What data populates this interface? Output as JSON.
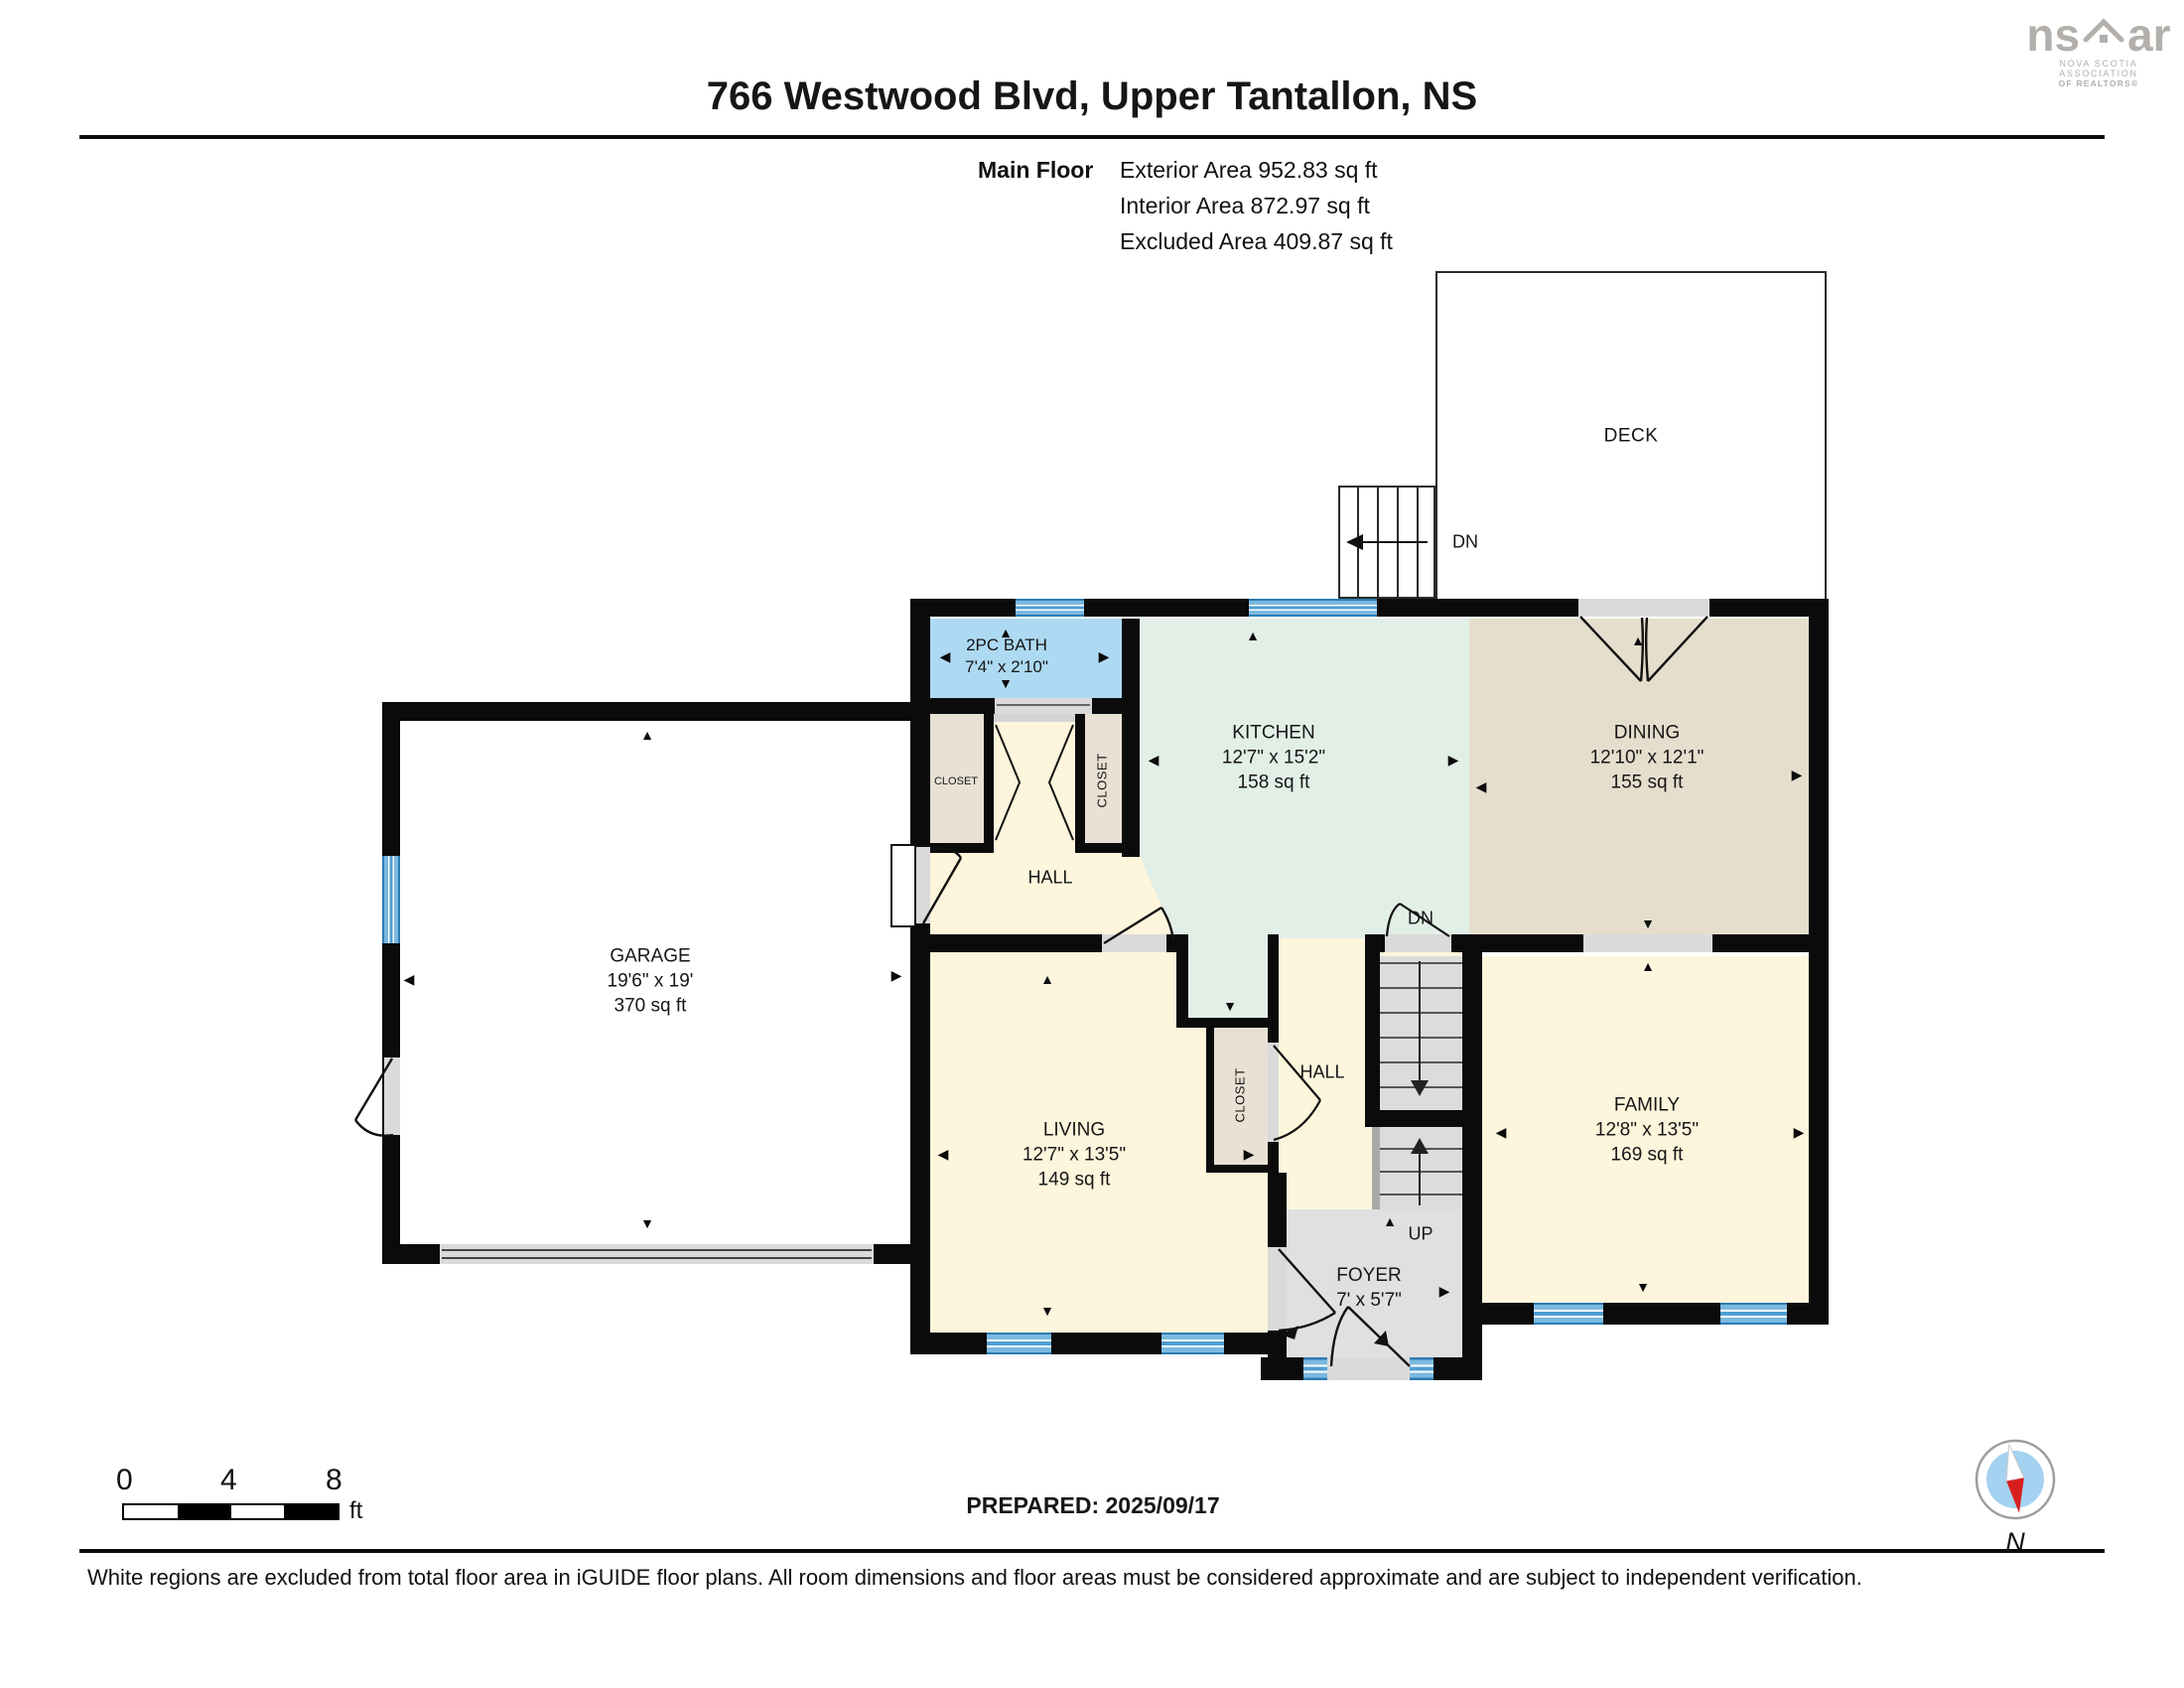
{
  "header": {
    "title": "766 Westwood Blvd, Upper Tantallon, NS",
    "floor_label": "Main Floor",
    "areas": [
      "Exterior Area 952.83 sq ft",
      "Interior Area 872.97 sq ft",
      "Excluded Area 409.87 sq ft"
    ]
  },
  "logo": {
    "brand_left": "ns",
    "brand_right": "ar",
    "line1": "NOVA SCOTIA ASSOCIATION",
    "line2": "OF REALTORS®"
  },
  "rooms": {
    "deck": {
      "name": "DECK"
    },
    "garage": {
      "name": "GARAGE",
      "dim": "19'6\" x 19'",
      "area": "370 sq ft"
    },
    "bath": {
      "name": "2PC BATH",
      "dim": "7'4\" x 2'10\""
    },
    "kitchen": {
      "name": "KITCHEN",
      "dim": "12'7\" x 15'2\"",
      "area": "158 sq ft"
    },
    "dining": {
      "name": "DINING",
      "dim": "12'10\" x 12'1\"",
      "area": "155 sq ft"
    },
    "living": {
      "name": "LIVING",
      "dim": "12'7\" x 13'5\"",
      "area": "149 sq ft"
    },
    "family": {
      "name": "FAMILY",
      "dim": "12'8\" x 13'5\"",
      "area": "169 sq ft"
    },
    "foyer": {
      "name": "FOYER",
      "dim": "7' x 5'7\""
    },
    "hall_upper": "HALL",
    "hall_lower": "HALL",
    "closet_left": "CLOSET",
    "closet_right": "CLOSET",
    "closet_lower": "CLOSET",
    "stairs": {
      "dn_outdoor": "DN",
      "dn": "DN",
      "up": "UP"
    }
  },
  "glyphs": {
    "up": "▲",
    "down": "▼",
    "left": "◀",
    "right": "▶"
  },
  "scalebar": {
    "ticks": [
      "0",
      "4",
      "8"
    ],
    "unit": "ft"
  },
  "footer": {
    "prepared": "PREPARED: 2025/09/17",
    "compass_label": "N",
    "disclaimer": "White regions are excluded from total floor area in iGUIDE floor plans. All room dimensions and floor areas must be considered approximate and are subject to independent verification."
  },
  "colors": {
    "wall": "#0b0b0b",
    "window_blue": "#4f9ed3",
    "bath_blue": "#aed9f2",
    "kitchen_green": "#e2efe7",
    "dining_tan": "#e6decd",
    "closet_tan": "#e9e1d4",
    "room_cream": "#fdf5dc",
    "stair_gray": "#dcdcdc",
    "foyer_gray": "#e0e0e0",
    "compass_red": "#d81f1f",
    "compass_blue": "#a5d2f0",
    "logo_gray": "#b3afab"
  }
}
